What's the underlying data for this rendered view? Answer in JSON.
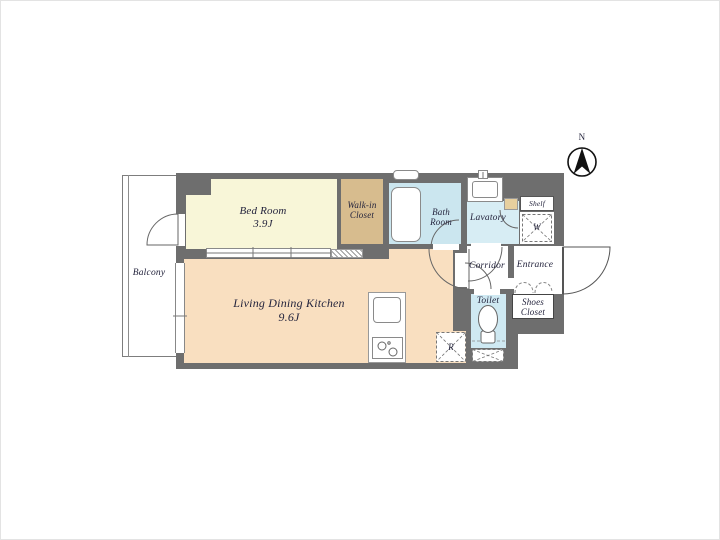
{
  "plan": {
    "type": "apartment-floor-plan",
    "compass": {
      "north_label": "N"
    },
    "rooms": {
      "bedroom": {
        "name": "Bed Room",
        "area": "3.9J"
      },
      "ldk": {
        "name": "Living Dining Kitchen",
        "area": "9.6J"
      },
      "wic": {
        "line1": "Walk-in",
        "line2": "Closet"
      },
      "bath": {
        "line1": "Bath",
        "line2": "Room"
      },
      "lavatory": {
        "name": "Lavatory"
      },
      "corridor": {
        "name": "Corridor"
      },
      "entrance": {
        "name": "Entrance"
      },
      "toilet": {
        "name": "Toilet"
      },
      "shoes_closet": {
        "line1": "Shoes",
        "line2": "Closet"
      },
      "shelf": {
        "name": "Shelf"
      },
      "washer_space": {
        "abbr": "W"
      },
      "refrigerator_space": {
        "abbr": "R"
      },
      "balcony": {
        "name": "Balcony"
      }
    },
    "colors": {
      "wall": "#6e6e6e",
      "bedroom_floor": "#f8f6d8",
      "wic_floor": "#d7bc8e",
      "ldk_floor": "#f9dfc0",
      "bath_floor": "#cbe6ef",
      "lavatory_floor": "#d7edf4",
      "toilet_floor": "#cfe9f2",
      "door_panel_tan": "#e7cf9e",
      "line_gray": "#777777",
      "text": "#23233c"
    }
  }
}
